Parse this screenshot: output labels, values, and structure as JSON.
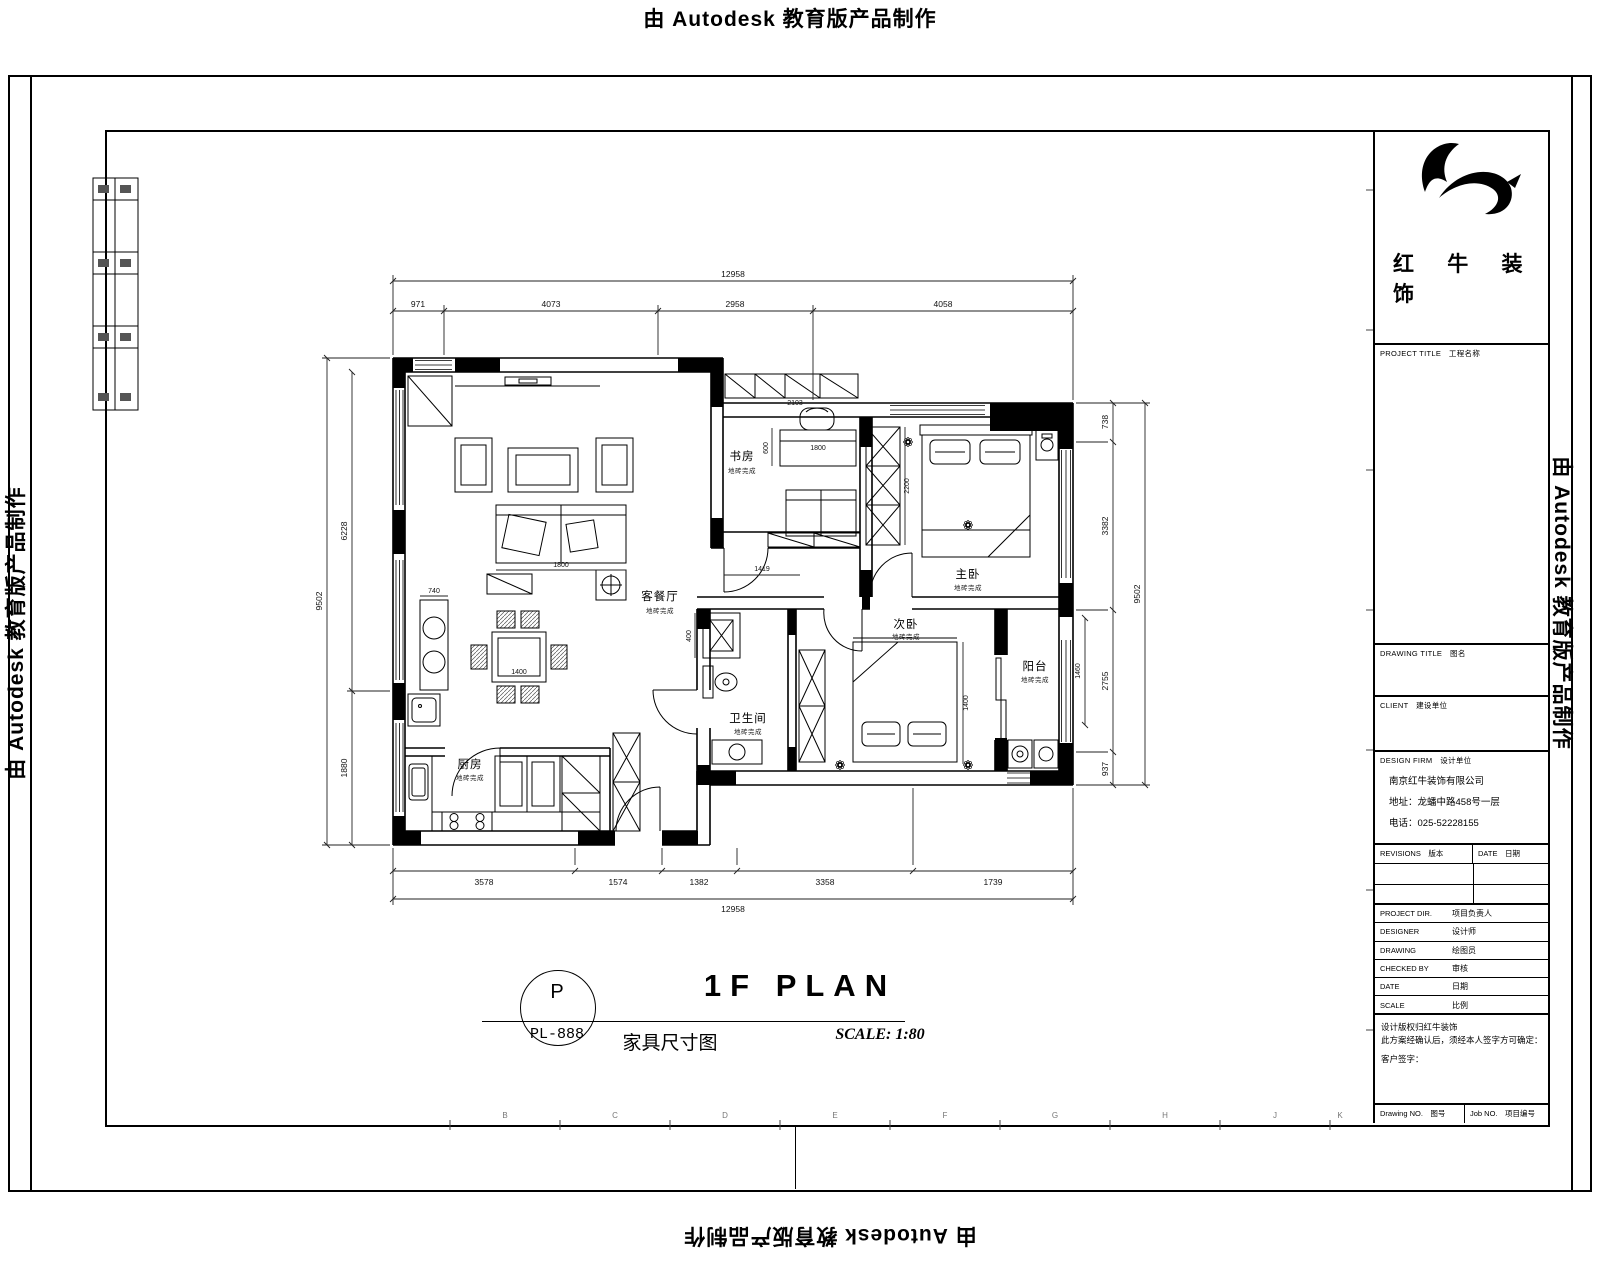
{
  "watermark": "由 Autodesk 教育版产品制作",
  "plan": {
    "rooms": {
      "living": {
        "name": "客餐厅",
        "sub": "地砖完成"
      },
      "study": {
        "name": "书房",
        "sub": "地砖完成"
      },
      "master": {
        "name": "主卧",
        "sub": "地砖完成"
      },
      "second": {
        "name": "次卧",
        "sub": "地砖完成"
      },
      "balcony": {
        "name": "阳台",
        "sub": "地砖完成"
      },
      "bath": {
        "name": "卫生间",
        "sub": "地砖完成"
      },
      "kitchen": {
        "name": "厨房",
        "sub": "地砖完成"
      }
    },
    "dims": {
      "top_total": "12958",
      "bottom_total": "12958",
      "left_total": "9502",
      "right_total": "9502",
      "top": [
        "971",
        "4073",
        "2958",
        "4058"
      ],
      "bottom": [
        "3578",
        "1574",
        "1382",
        "3358",
        "1739"
      ],
      "left": [
        "6228",
        "1880"
      ],
      "right": [
        "738",
        "3382",
        "2755",
        "937"
      ],
      "inner": {
        "sofa": "1800",
        "desk": "1800",
        "study_top": "2103",
        "corridor": "1419",
        "niche": "400",
        "wardrobe": "2200",
        "balcony": "1460",
        "bar": "740",
        "dining": "1400",
        "desk_side": "600",
        "bed2": "1400"
      }
    }
  },
  "titlearea": {
    "bubble_letter": "P",
    "bubble_code": "PL-888",
    "cn_title": "家具尺寸图",
    "en_title": "1F PLAN",
    "scale": "SCALE: 1:80"
  },
  "titleblock": {
    "logo_line1": "红 牛 装",
    "logo_line2": "饰",
    "project_title": "PROJECT TITLE　工程名称",
    "drawing_title": "DRAWING TITLE　图名",
    "client": "CLIENT　建设单位",
    "design_firm": "DESIGN FIRM　设计单位",
    "company": "南京红牛装饰有限公司",
    "address": "地址：龙蟠中路458号一层",
    "phone": "电话：025-52228155",
    "rev_col": "REVISIONS　版本",
    "date_col": "DATE　日期",
    "rows": [
      {
        "en": "PROJECT DIR.",
        "cn": "项目负责人"
      },
      {
        "en": "DESIGNER",
        "cn": "设计师"
      },
      {
        "en": "DRAWING",
        "cn": "绘图员"
      },
      {
        "en": "CHECKED BY",
        "cn": "审核"
      },
      {
        "en": "DATE",
        "cn": "日期"
      },
      {
        "en": "SCALE",
        "cn": "比例"
      }
    ],
    "note1": "设计版权归红牛装饰",
    "note2": "此方案经确认后，须经本人签字方可确定：",
    "note3": "客户签字：",
    "drawing_no": "Drawing NO.　图号",
    "job_no": "Job NO.　项目编号"
  },
  "grid": {
    "letters": [
      "B",
      "C",
      "D",
      "E",
      "F",
      "G",
      "H",
      "J",
      "K"
    ]
  }
}
